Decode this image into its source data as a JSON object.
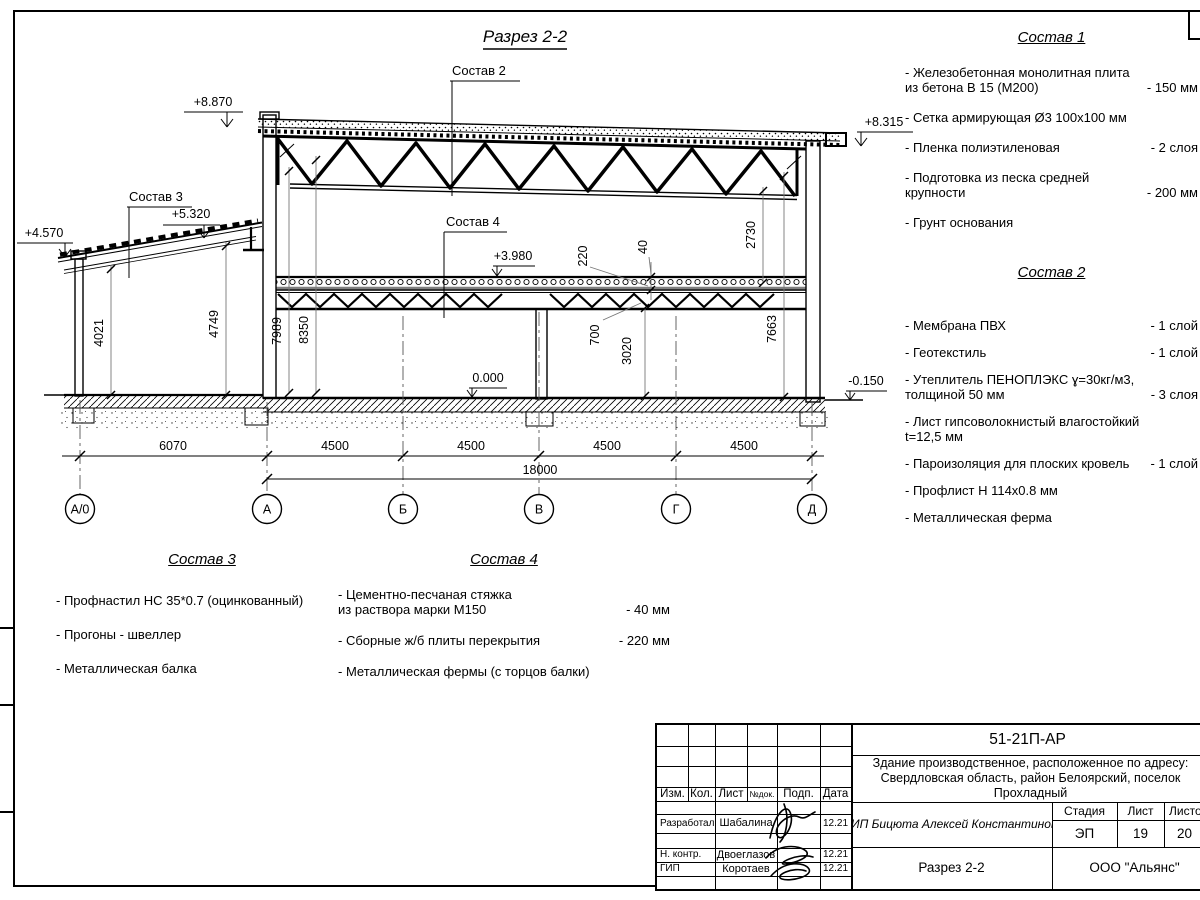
{
  "title": "Разрез 2-2",
  "drawing": {
    "callouts": {
      "c2": "Состав 2",
      "c3": "Состав 3",
      "c4": "Состав 4"
    },
    "levels": {
      "l8870": "+8.870",
      "l8315": "+8.315",
      "l4570": "+4.570",
      "l5320": "+5.320",
      "l3980": "+3.980",
      "l0": "0.000",
      "lm150": "-0.150"
    },
    "vdims": {
      "d4021": "4021",
      "d4749": "4749",
      "d7989": "7989",
      "d8350": "8350",
      "d2730": "2730",
      "d7663": "7663",
      "d220": "220",
      "d40": "40",
      "d700": "700",
      "d3020": "3020"
    },
    "hdims": {
      "spans": [
        "6070",
        "4500",
        "4500",
        "4500",
        "4500"
      ],
      "total": "18000"
    },
    "axes": [
      "А/0",
      "А",
      "Б",
      "В",
      "Г",
      "Д"
    ]
  },
  "compositions": [
    {
      "title": "Состав 1",
      "items": [
        {
          "name": "- Железобетонная  монолитная плита\nиз бетона В 15 (М200)",
          "value": "- 150 мм"
        },
        {
          "name": "- Сетка армирующая Ø3 100х100 мм",
          "value": ""
        },
        {
          "name": "- Пленка полиэтиленовая",
          "value": "- 2 слоя"
        },
        {
          "name": "- Подготовка из песка средней\nкрупности",
          "value": "- 200 мм"
        },
        {
          "name": "- Грунт основания",
          "value": ""
        }
      ]
    },
    {
      "title": "Состав 2",
      "items": [
        {
          "name": "- Мембрана ПВХ",
          "value": "- 1 слой"
        },
        {
          "name": "- Геотекстиль",
          "value": "- 1 слой"
        },
        {
          "name": "- Утеплитель ПЕНОПЛЭКС ɣ=30кг/м3,\nтолщиной 50 мм",
          "value": "- 3 слоя"
        },
        {
          "name": "- Лист гипсоволокнистый влагостойкий\nt=12,5 мм",
          "value": ""
        },
        {
          "name": "- Пароизоляция для плоских кровель",
          "value": "- 1 слой"
        },
        {
          "name": "- Профлист Н 114х0.8 мм",
          "value": ""
        },
        {
          "name": "- Металлическая ферма",
          "value": ""
        }
      ]
    },
    {
      "title": "Состав 3",
      "items": [
        {
          "name": "- Профнастил НС 35*0.7 (оцинкованный)",
          "value": ""
        },
        {
          "name": "- Прогоны - швеллер",
          "value": ""
        },
        {
          "name": "- Металлическая балка",
          "value": ""
        }
      ]
    },
    {
      "title": "Состав 4",
      "items": [
        {
          "name": "- Цементно-песчаная стяжка\nиз раствора марки М150",
          "value": "- 40 мм"
        },
        {
          "name": "- Сборные ж/б плиты перекрытия",
          "value": "- 220 мм"
        },
        {
          "name": "- Металлическая фермы (с торцов балки)",
          "value": ""
        }
      ]
    }
  ],
  "titleblock": {
    "doc_number": "51-21П-АР",
    "project": "Здание производственное, расположенное по адресу:\nСвердловская область, район Белоярский, поселок\nПрохладный",
    "client": "ИП Бицюта Алексей Константинович",
    "stage_label": "Стадия",
    "sheet_label": "Лист",
    "sheets_label": "Листов",
    "stage": "ЭП",
    "sheet": "19",
    "sheets": "20",
    "sheet_title": "Разрез 2-2",
    "company": "ООО \"Альянс\"",
    "header": {
      "izm": "Изм.",
      "kol": "Кол.",
      "list": "Лист",
      "ndok": "№док.",
      "podp": "Подп.",
      "data": "Дата"
    },
    "rows": [
      {
        "role": "Разработал",
        "name": "Шабалина",
        "date": "12.21"
      },
      {
        "role": "Н. контр.",
        "name": "Двоеглазов",
        "date": "12.21"
      },
      {
        "role": "ГИП",
        "name": "Коротаев",
        "date": "12.21"
      }
    ]
  }
}
